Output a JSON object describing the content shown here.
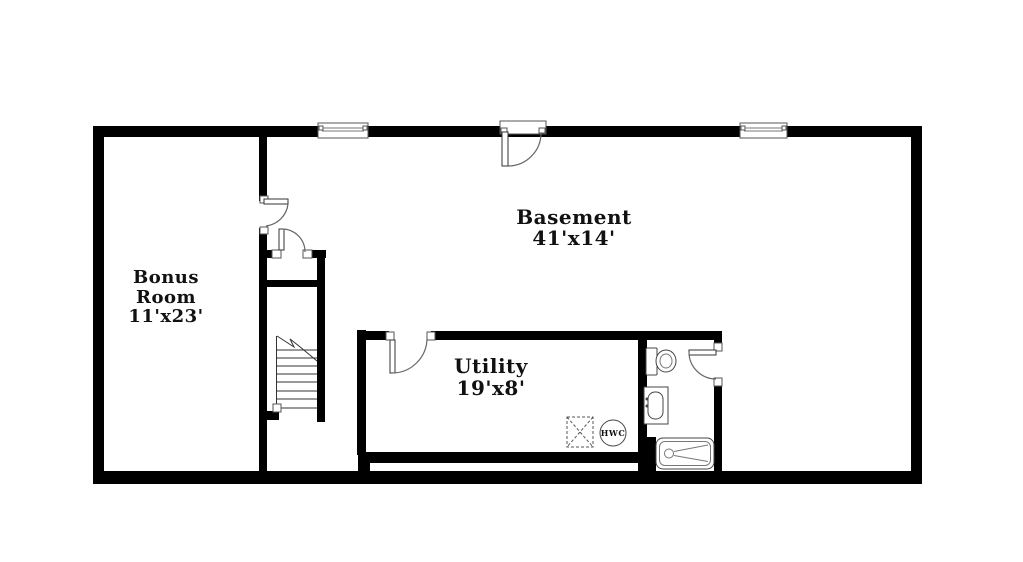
{
  "floor_plan": {
    "rooms": {
      "basement": {
        "name": "Basement",
        "dimensions": "41'x14'"
      },
      "bonus_room": {
        "name_line1": "Bonus",
        "name_line2": "Room",
        "dimensions": "11'x23'"
      },
      "utility": {
        "name": "Utility",
        "dimensions": "19'x8'"
      }
    },
    "fixtures": {
      "hot_water_cylinder": {
        "label": "HWC"
      },
      "icons": [
        "toilet-icon",
        "sink-vanity-icon",
        "bathtub-icon",
        "stairs-icon",
        "hot-water-cylinder-icon",
        "appliance-space-icon",
        "window-icon",
        "door-swing-icon"
      ]
    },
    "colors": {
      "wall": "#000000",
      "fixture_line": "#444444",
      "label_text": "#111111",
      "background": "#ffffff"
    }
  }
}
